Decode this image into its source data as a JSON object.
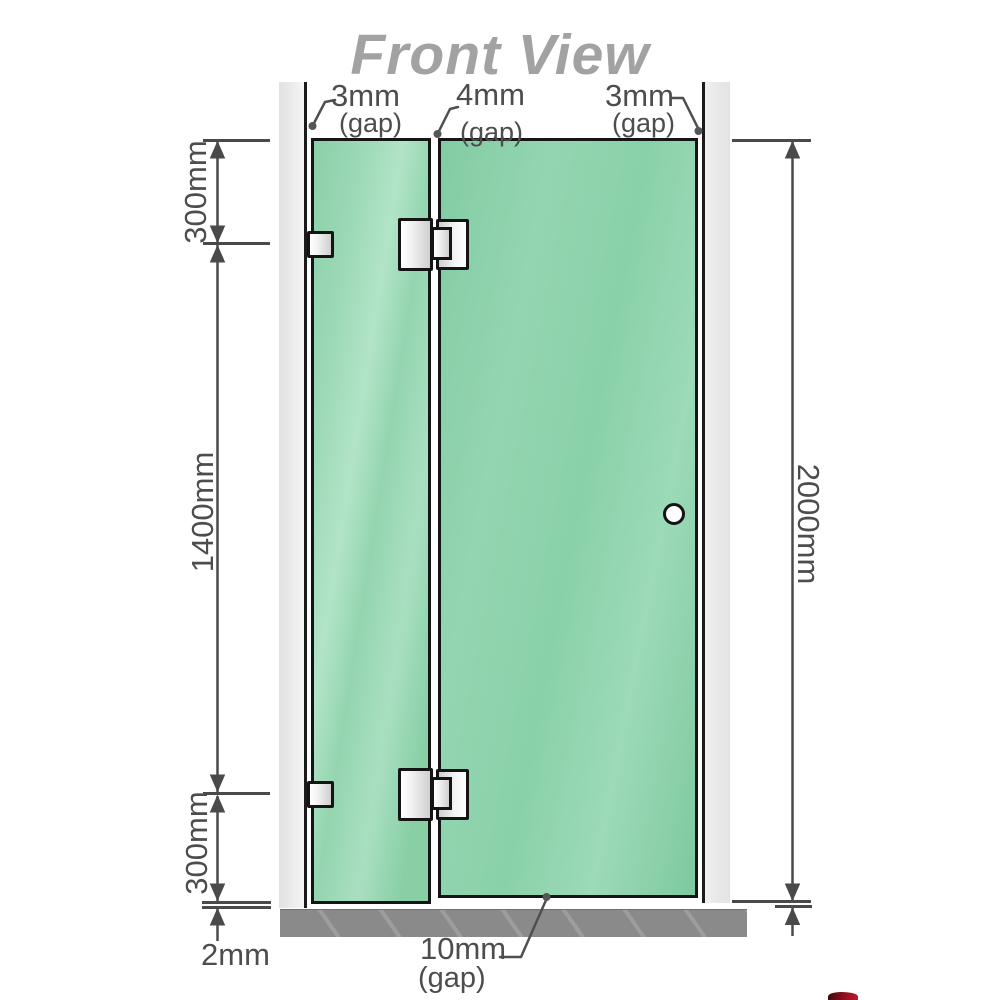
{
  "title": "Front View",
  "measurements": {
    "top_gaps": [
      {
        "value": "3mm",
        "sub": "(gap)"
      },
      {
        "value": "4mm",
        "sub": "(gap)"
      },
      {
        "value": "3mm",
        "sub": "(gap)"
      }
    ],
    "left_segments": {
      "top": "300mm",
      "middle": "1400mm",
      "bottom": "300mm"
    },
    "total_height": "2000mm",
    "floor_gap": "2mm",
    "bottom_gap": {
      "value": "10mm",
      "sub": "(gap)"
    }
  },
  "colors": {
    "glass_green": "#8ed3ae",
    "wall_gray": "#e9e9e9",
    "floor_gray": "#8a8a8a",
    "dimension_gray": "#4a4a4a",
    "title_gray": "#a2a2a2",
    "logo_red": "#8e1020"
  }
}
